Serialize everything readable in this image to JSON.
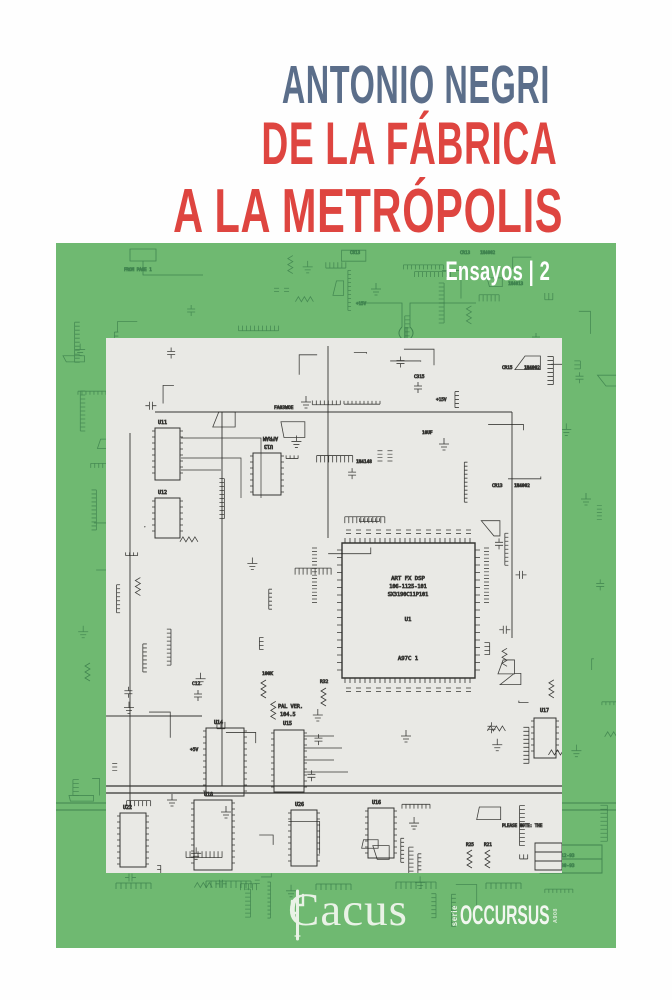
{
  "cover": {
    "author": "ANTONIO NEGRI",
    "title_line1": "DE LA FÁBRICA",
    "title_line2": "A LA METRÓPOLIS",
    "series_label": "Ensayos | 2"
  },
  "footer": {
    "publisher_pre": "Cac",
    "publisher_post": "us",
    "publisher_full": "Cactus",
    "series_vertical": "serie",
    "series_wordmark": "OCCURSUS",
    "series_side_mark": "A908"
  },
  "colors": {
    "author_blue": "#5b6e8a",
    "title_red": "#de4540",
    "band_green": "#6fb971",
    "trace_green": "#2d6e41",
    "schematic_bg": "#e9e9e5",
    "schematic_ink": "#22221f",
    "logo_white": "#e9f2e6"
  },
  "schematic": {
    "chip_u1": {
      "line1": "ART FX DSP",
      "line2": "106-1125-101",
      "line3": "SX3190C11P101",
      "ref": "U1",
      "sub": "A97C 1"
    },
    "labels": {
      "u11": "U11",
      "u12": "U12",
      "u13": "U13",
      "afram": "AFRAM",
      "u14": "U14",
      "u15": "U15",
      "u16": "U16",
      "u17": "U17",
      "u18": "U18",
      "u22": "U22",
      "u26": "U26",
      "pal1": "PAL VER.",
      "pal2": "104.5",
      "fa03woe": "FA03WOE",
      "c12": "C12",
      "c315": "C315",
      "cr13": "CR13",
      "cr15": "CR15",
      "d1": "1N4002",
      "d2": "1N4002",
      "d3": "1N4148",
      "k100": "100K",
      "p5v": "+5V",
      "p15v": "+15V",
      "r32": "R32",
      "r25": "R25",
      "r21": "R21",
      "uf10": "10UF",
      "note": "PLEASE NOTE: THE"
    },
    "rev": {
      "r1": "1-12-93",
      "r2": "7-30-93"
    }
  },
  "band": {
    "labels": {
      "from_page": "FROM PAGE 1",
      "b1": "C813",
      "b2": "1N4013",
      "b3": "CR13",
      "b4": "1N4002",
      "b5": "22UF",
      "b6": "+15V"
    }
  }
}
